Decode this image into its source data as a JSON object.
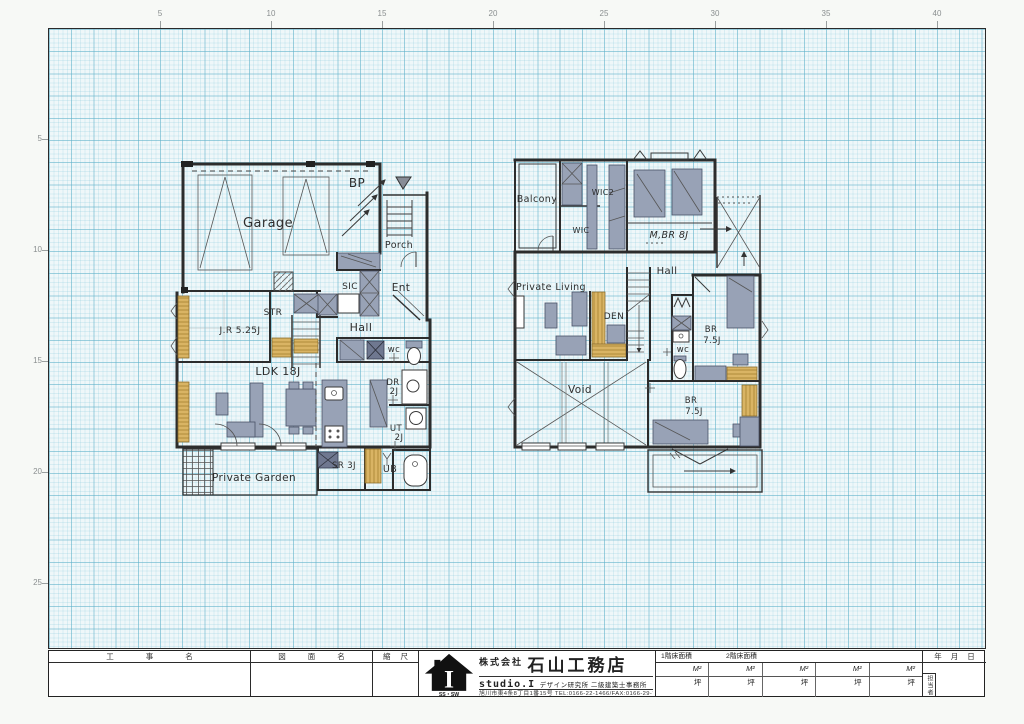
{
  "rulers": {
    "top": [
      "5",
      "10",
      "15",
      "20",
      "25",
      "30",
      "35",
      "40"
    ],
    "left": [
      "5",
      "10",
      "15",
      "20",
      "25"
    ]
  },
  "plans": {
    "floor1": {
      "rooms": {
        "garage": "Garage",
        "bp": "BP",
        "porch": "Porch",
        "ent": "Ent",
        "sic": "SIC",
        "str": "STR",
        "jr": "J.R 5.25J",
        "hall": "Hall",
        "wc": "wc",
        "ldk": "LDK 18J",
        "dr": [
          "DR",
          "2J"
        ],
        "ut": [
          "UT",
          "2J"
        ],
        "sr": "SR 3J",
        "ub": "UB",
        "private_garden": "Private Garden"
      }
    },
    "floor2": {
      "rooms": {
        "balcony": "Balcony",
        "wic2": "WIC2",
        "wic": "WIC",
        "mbr": "M,BR 8J",
        "hall": "Hall",
        "private_living": "Private Living",
        "den": "DEN",
        "wc": "wc",
        "br1": [
          "BR",
          "7.5J"
        ],
        "br2": [
          "BR",
          "7.5J"
        ],
        "void": "Void"
      }
    }
  },
  "title_block": {
    "koji_label": "工事名",
    "zumen_label": "図面名",
    "scale_label": "縮尺",
    "company_prefix": "株式会社",
    "company_name": "石山工務店",
    "studio": "studio.I",
    "studio_desc": "デザイン研究所 二級建築士事務所",
    "address": "旭川市東4条8丁目1番15号 TEL:0166-22-1466/FAX:0166-29-7391",
    "logo_letter": "I",
    "logo_sub": "SS・SW",
    "area1_label": "1階床面積",
    "area2_label": "2階床面積",
    "m2_unit": "M²",
    "tsubo_unit": "坪",
    "date_label": "年月日",
    "staff_label": "担当者"
  }
}
